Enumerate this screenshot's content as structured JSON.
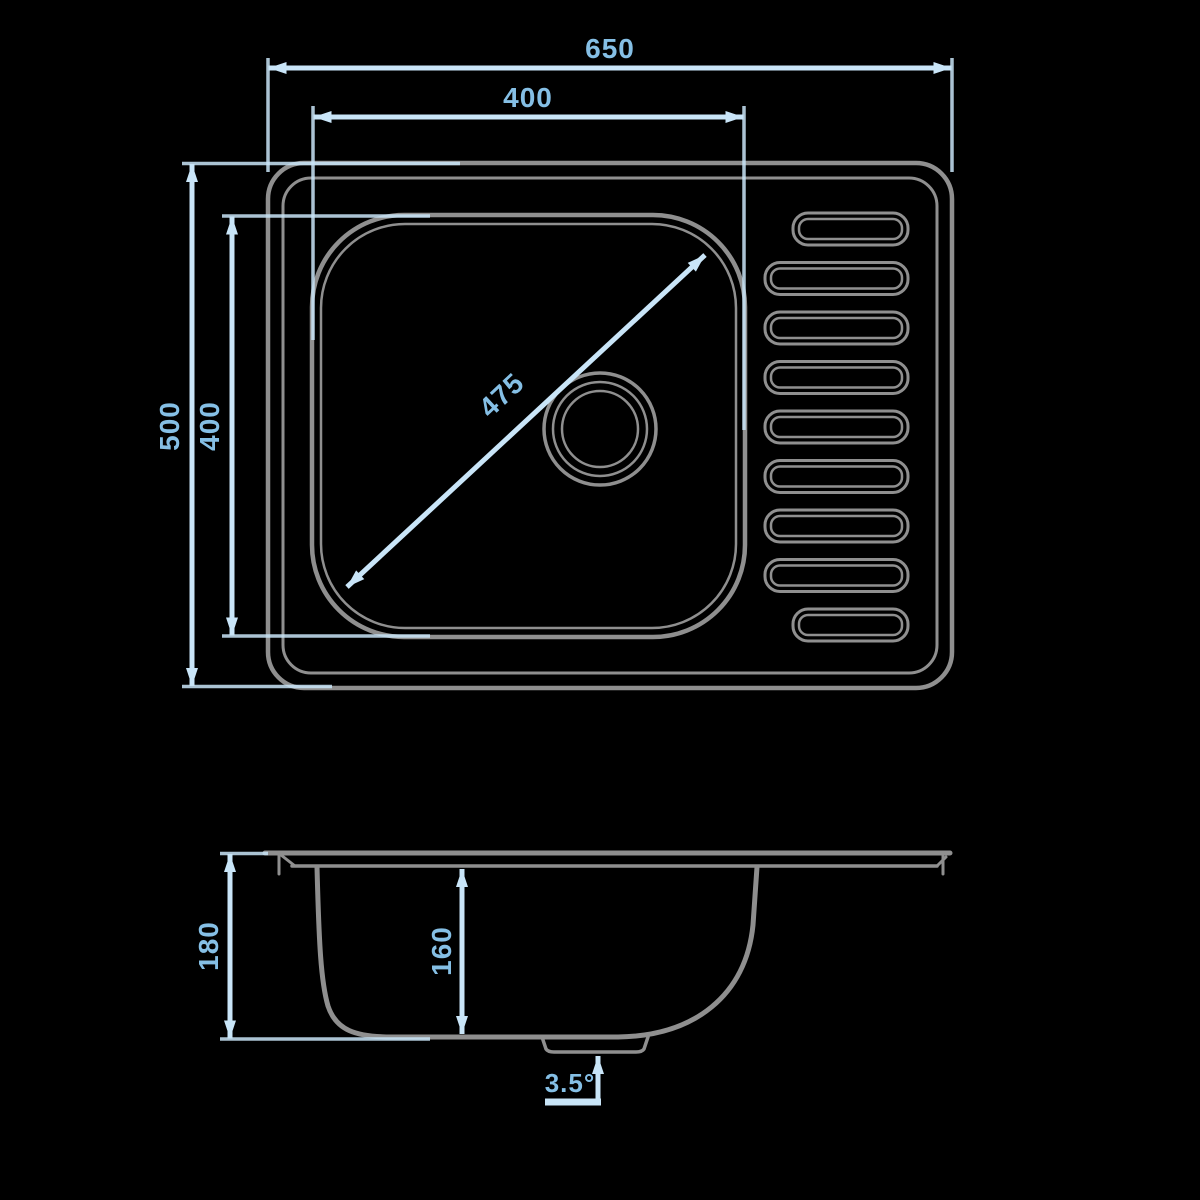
{
  "colors": {
    "background": "#000000",
    "line": "#8f8f8f",
    "dim_line": "#c9e5f8",
    "dim_text": "#85bfe5"
  },
  "top_view": {
    "overall_width": "650",
    "bowl_width": "400",
    "overall_depth": "500",
    "bowl_depth": "400",
    "bowl_diagonal": "475",
    "drainboard_slot_count": "9"
  },
  "section_view": {
    "overall_height": "180",
    "bowl_inner_depth": "160",
    "drainboard_angle": "3.5°"
  }
}
